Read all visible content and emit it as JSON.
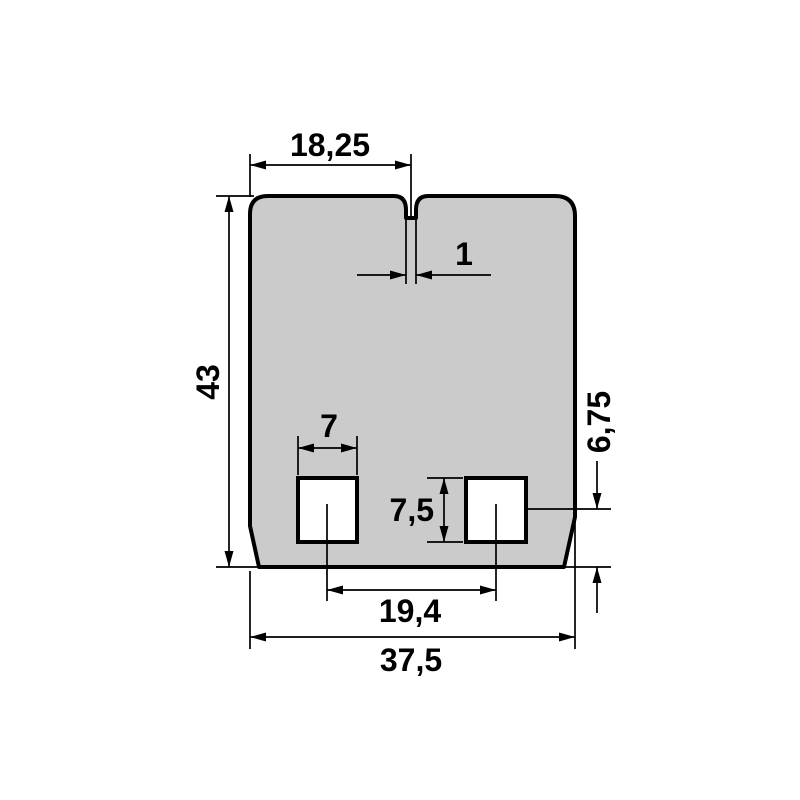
{
  "drawing": {
    "kind": "technical-dimension-drawing",
    "dimensions": {
      "top_width": "18,25",
      "notch_width": "1",
      "height": "43",
      "cutout_width": "7",
      "cutout_height": "7,5",
      "cutout_center_to_bottom": "6,75",
      "cutout_spacing": "19,4",
      "total_width": "37,5"
    },
    "colors": {
      "part_fill": "#cbcbcb",
      "line": "#000000",
      "background": "#ffffff"
    }
  }
}
